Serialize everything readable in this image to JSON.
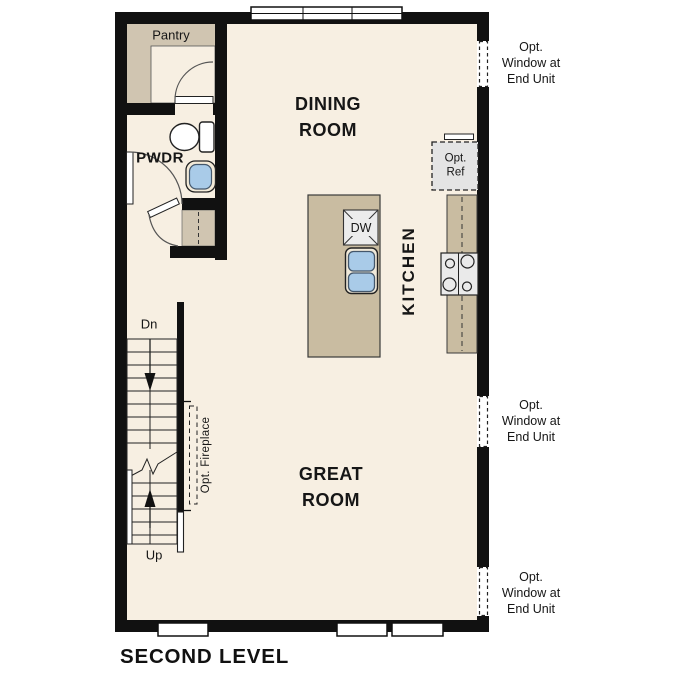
{
  "plan_title": "SECOND LEVEL",
  "rooms": {
    "pantry": "Pantry",
    "powder": "PWDR",
    "dining": [
      "DINING",
      "ROOM"
    ],
    "kitchen": "KITCHEN",
    "great": [
      "GREAT",
      "ROOM"
    ]
  },
  "stairs": {
    "down": "Dn",
    "up": "Up"
  },
  "annotations": {
    "dishwasher": "DW",
    "opt_ref": [
      "Opt.",
      "Ref"
    ],
    "opt_fireplace": "Opt. Fireplace",
    "window_note": [
      "Opt.",
      "Window at",
      "End Unit"
    ]
  },
  "colors": {
    "floor": "#f7efe2",
    "casework_tan": "#c9bca1",
    "millwork_tan": "#d0c5b1",
    "fixture_blue": "#a9cbe8",
    "appliance_gray": "#e9e9e9",
    "wall_black": "#111111"
  }
}
